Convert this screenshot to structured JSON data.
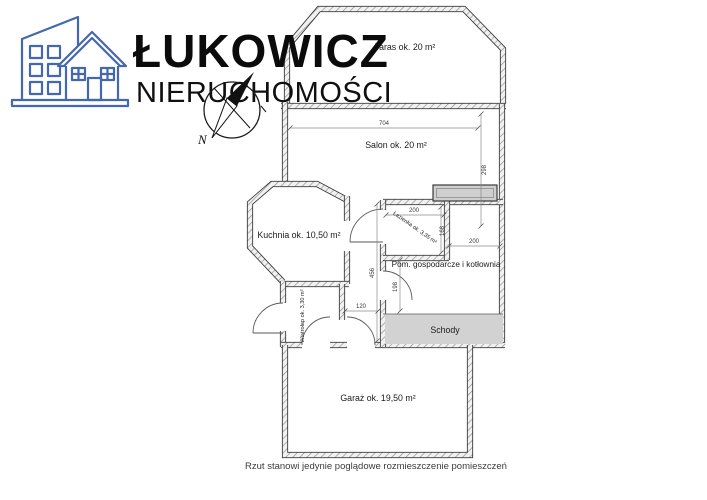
{
  "logo": {
    "brand": "ŁUKOWICZ",
    "subtitle": "NIERUCHOMOŚCI",
    "compass_north": "N"
  },
  "plan": {
    "rooms": {
      "taras": {
        "label": "Taras ok. 20 m²"
      },
      "salon": {
        "label": "Salon ok. 20 m²"
      },
      "kuchnia": {
        "label": "Kuchnia ok. 10,50 m²"
      },
      "lazienka": {
        "label": "Łazienka ok. 3,35 m²"
      },
      "pom_gospodarcze": {
        "label": "Pom. gospodarcze i kotłownia"
      },
      "schody": {
        "label": "Schody"
      },
      "wiatrolap": {
        "label": "Wiatrołap ok. 3,30 m²"
      },
      "garaz": {
        "label": "Garaż ok. 19,50 m²"
      }
    },
    "dimensions_cm": {
      "salon_width": "704",
      "salon_depth": "298",
      "lazienka_width": "200",
      "lazienka_depth": "168",
      "pom_width": "200",
      "pom_depth": "198",
      "hall_depth": "456",
      "hall_width": "120"
    }
  },
  "footer": {
    "disclaimer": "Rzut stanowi jedynie poglądowe rozmieszczenie pomieszczeń"
  },
  "colors": {
    "logo_blue": "#4468ad",
    "wall_dark": "#3b3b3b",
    "stairs_fill": "#d2d2d2",
    "text": "#1c1c1c"
  }
}
